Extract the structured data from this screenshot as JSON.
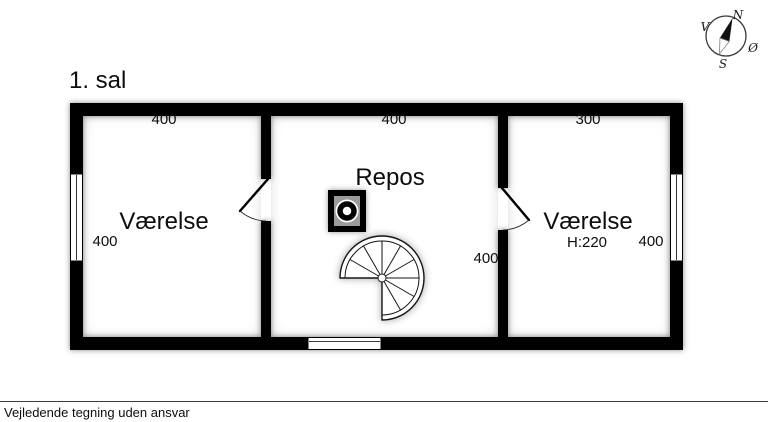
{
  "floor": {
    "title": "1. sal"
  },
  "compass": {
    "north": "N",
    "west": "V",
    "east": "Ø",
    "south": "S"
  },
  "rooms": [
    {
      "name": "Værelse",
      "top_dim": "400",
      "side_dim": "400"
    },
    {
      "name": "Repos",
      "top_dim": "400",
      "side_dim": "400"
    },
    {
      "name": "Værelse",
      "top_dim": "300",
      "side_dim": "400",
      "ceiling_height": "H:220"
    }
  ],
  "footer": {
    "disclaimer": "Vejledende tegning uden ansvar"
  },
  "colors": {
    "wall": "#000000",
    "background": "#ffffff",
    "chimney_inner": "#9b9b9b"
  }
}
